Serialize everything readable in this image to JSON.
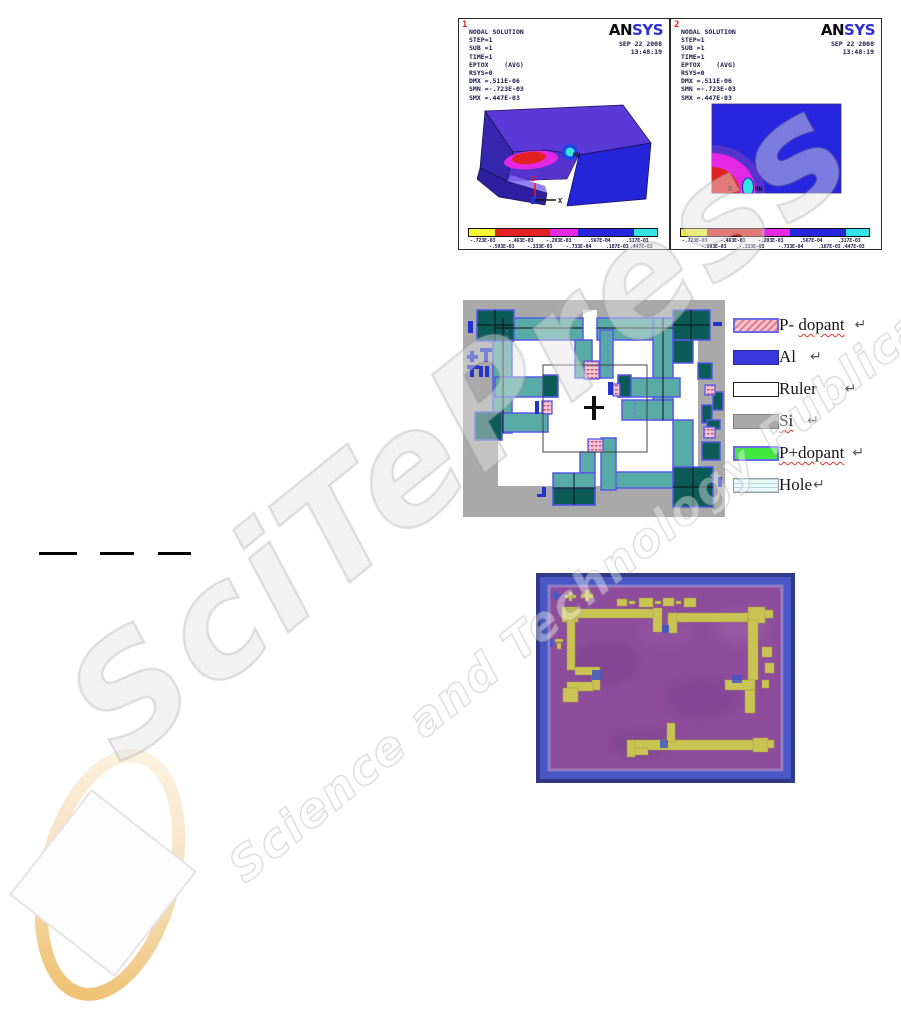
{
  "page": {
    "width": 901,
    "height": 1025,
    "background": "#ffffff"
  },
  "watermark": {
    "brand": "SciTePress",
    "tagline": "Science and Technology Publications"
  },
  "ansys": {
    "logo": {
      "an": "AN",
      "sys": "SYS"
    },
    "colorbar": {
      "colors": [
        "#f6f632",
        "#e42222",
        "#e428e4",
        "#2626de",
        "#34e4e4"
      ],
      "top": [
        "-.723E-03",
        "-.463E-03",
        "-.203E-03",
        ".567E-04",
        ".317E-03"
      ],
      "bottom": [
        "-.593E-03",
        "-.333E-03",
        "-.733E-04",
        ".187E-03",
        ".447E-03"
      ]
    },
    "panels": [
      {
        "number": "1",
        "date": "SEP 22 2008",
        "time": "13:48:19",
        "lines": [
          "NODAL SOLUTION",
          "STEP=1",
          "SUB =1",
          "TIME=1",
          "EPTOX    (AVG)",
          "RSYS=0",
          "DMX =.511E-06",
          "SMN =-.723E-03",
          "SMX =.447E-03"
        ],
        "marker": "MX",
        "axis_z": "Z",
        "axis_x": "X"
      },
      {
        "number": "2",
        "date": "SEP 22 2008",
        "time": "13:48:19",
        "lines": [
          "NODAL SOLUTION",
          "STEP=1",
          "SUB =1",
          "TIME=1",
          "EPTOX    (AVG)",
          "RSYS=0",
          "DMX =.511E-06",
          "SMN =-.723E-03",
          "SMX =.447E-03"
        ],
        "marker": "MN",
        "axis_z": "Z",
        "axis_x": "X"
      }
    ]
  },
  "mask": {
    "colors": {
      "background": "#a9a9a9",
      "beam_teal": "#57aaa5",
      "pad_dark_teal": "#0b5c58",
      "outline_blue": "#5858e8",
      "anchor_pink": "#f3c3d6",
      "mark_blue": "#2233cc"
    },
    "legend": [
      {
        "pre": "P- ",
        "wavy": "dopant",
        "ret": "↵"
      },
      {
        "pre": "Al",
        "wavy": "",
        "ret": "↵"
      },
      {
        "pre": "Ruler",
        "wavy": "",
        "ret": "↵"
      },
      {
        "pre": "",
        "wavy": "Si",
        "ret": "↵"
      },
      {
        "pre": "",
        "wavy": "P+dopant",
        "ret": "↵"
      },
      {
        "pre": "Hole",
        "wavy": "",
        "ret": "↵"
      }
    ]
  },
  "photo": {
    "colors": {
      "frame_blue": "#4a57c4",
      "field_purple": "#8e4d9c",
      "metal_yellow": "#c9c353",
      "mark_blue": "#3f58c8"
    }
  }
}
